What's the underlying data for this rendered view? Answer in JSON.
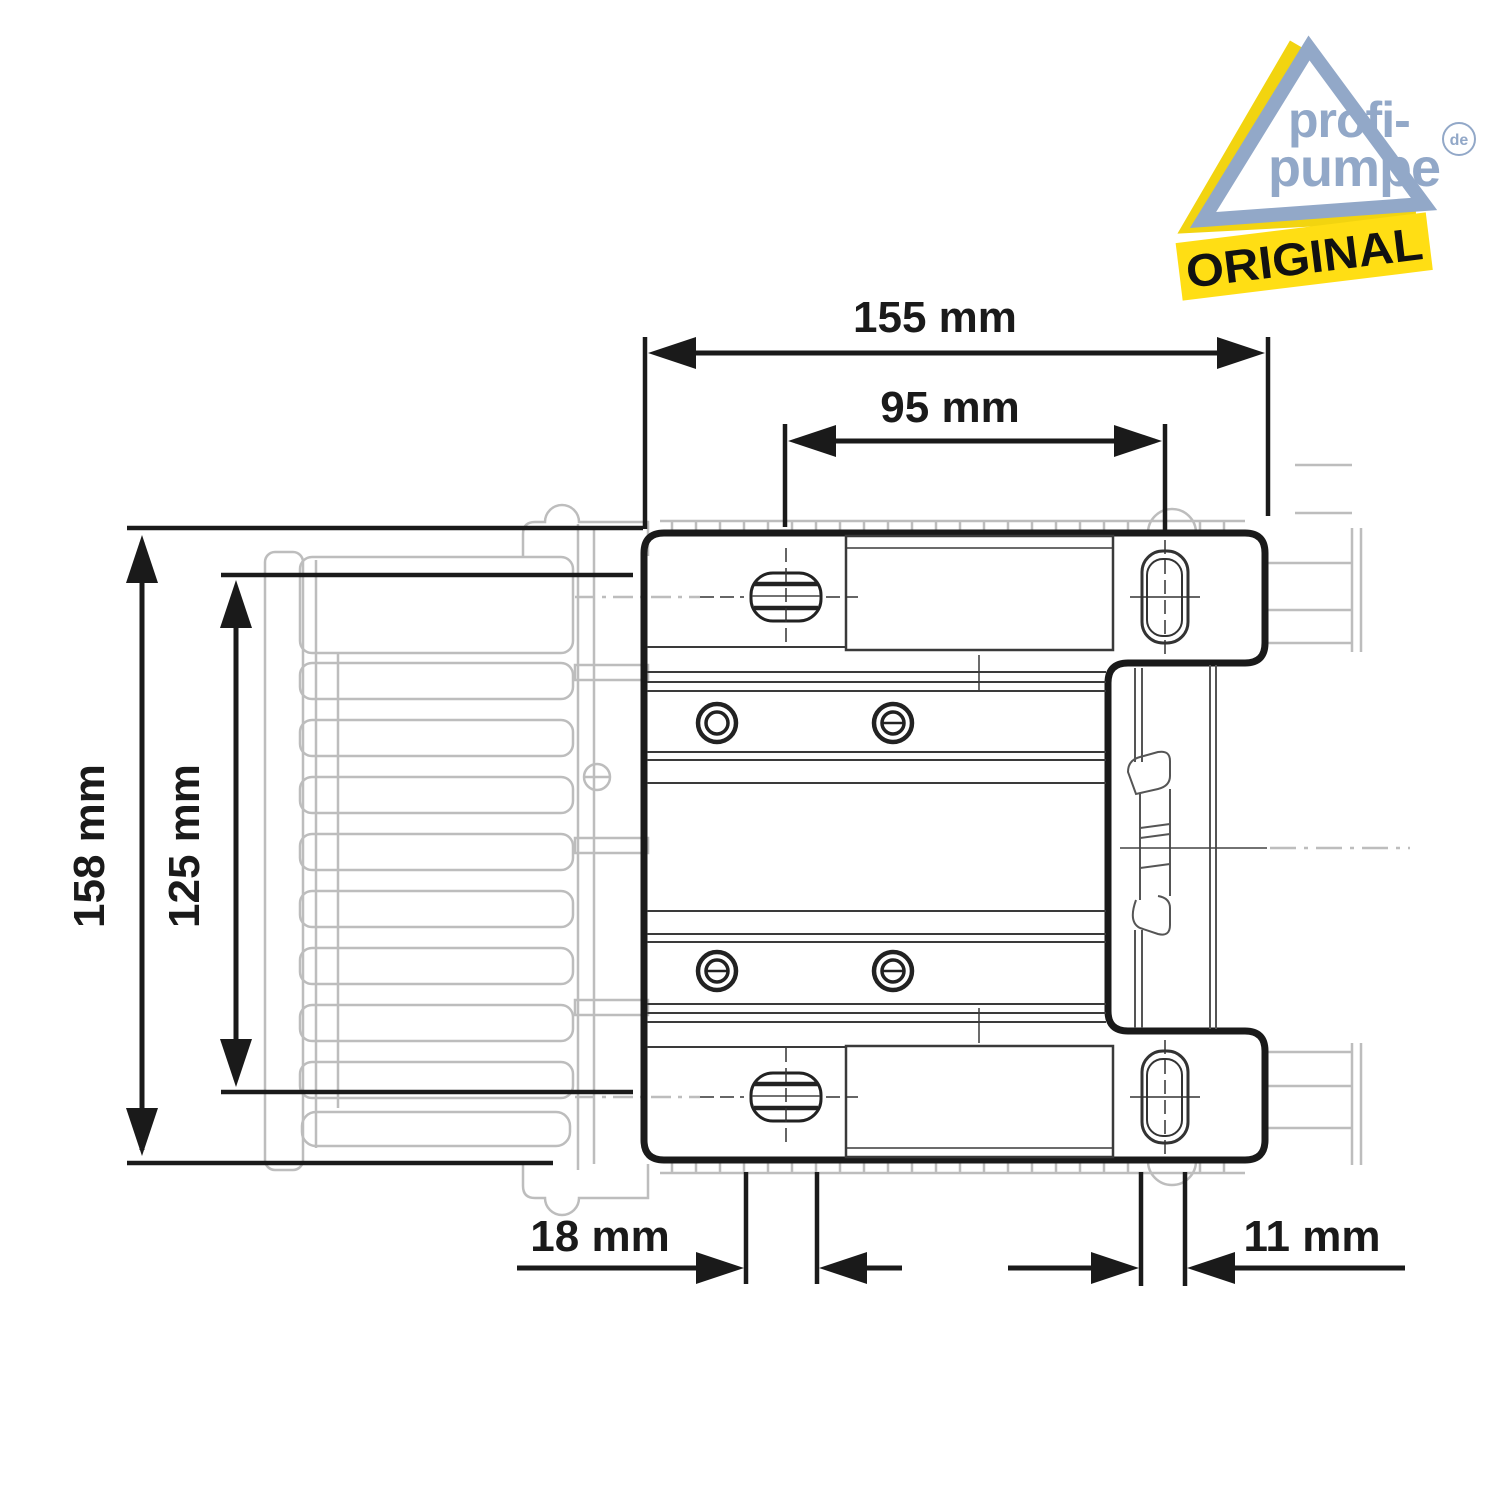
{
  "logo": {
    "word1": "profi-",
    "word2": "pumpe",
    "tld": "de",
    "banner": "ORIGINAL",
    "triangle_yellow": "#F2D410",
    "triangle_blue": "#92A8C8",
    "banner_yellow": "#FFDE14",
    "text_blue": "#92A8C8",
    "banner_text_color": "#111111"
  },
  "dimensions": {
    "total_width": "155 mm",
    "hole_spacing": "95 mm",
    "total_height": "158 mm",
    "body_height": "125 mm",
    "foot_offset": "18 mm",
    "slot_width": "11 mm"
  },
  "drawing": {
    "ink": "#1a1a1a",
    "detail_line": "#3a3a3a",
    "faded_gray": "#bdbdbd",
    "clip_gray": "#555555"
  }
}
